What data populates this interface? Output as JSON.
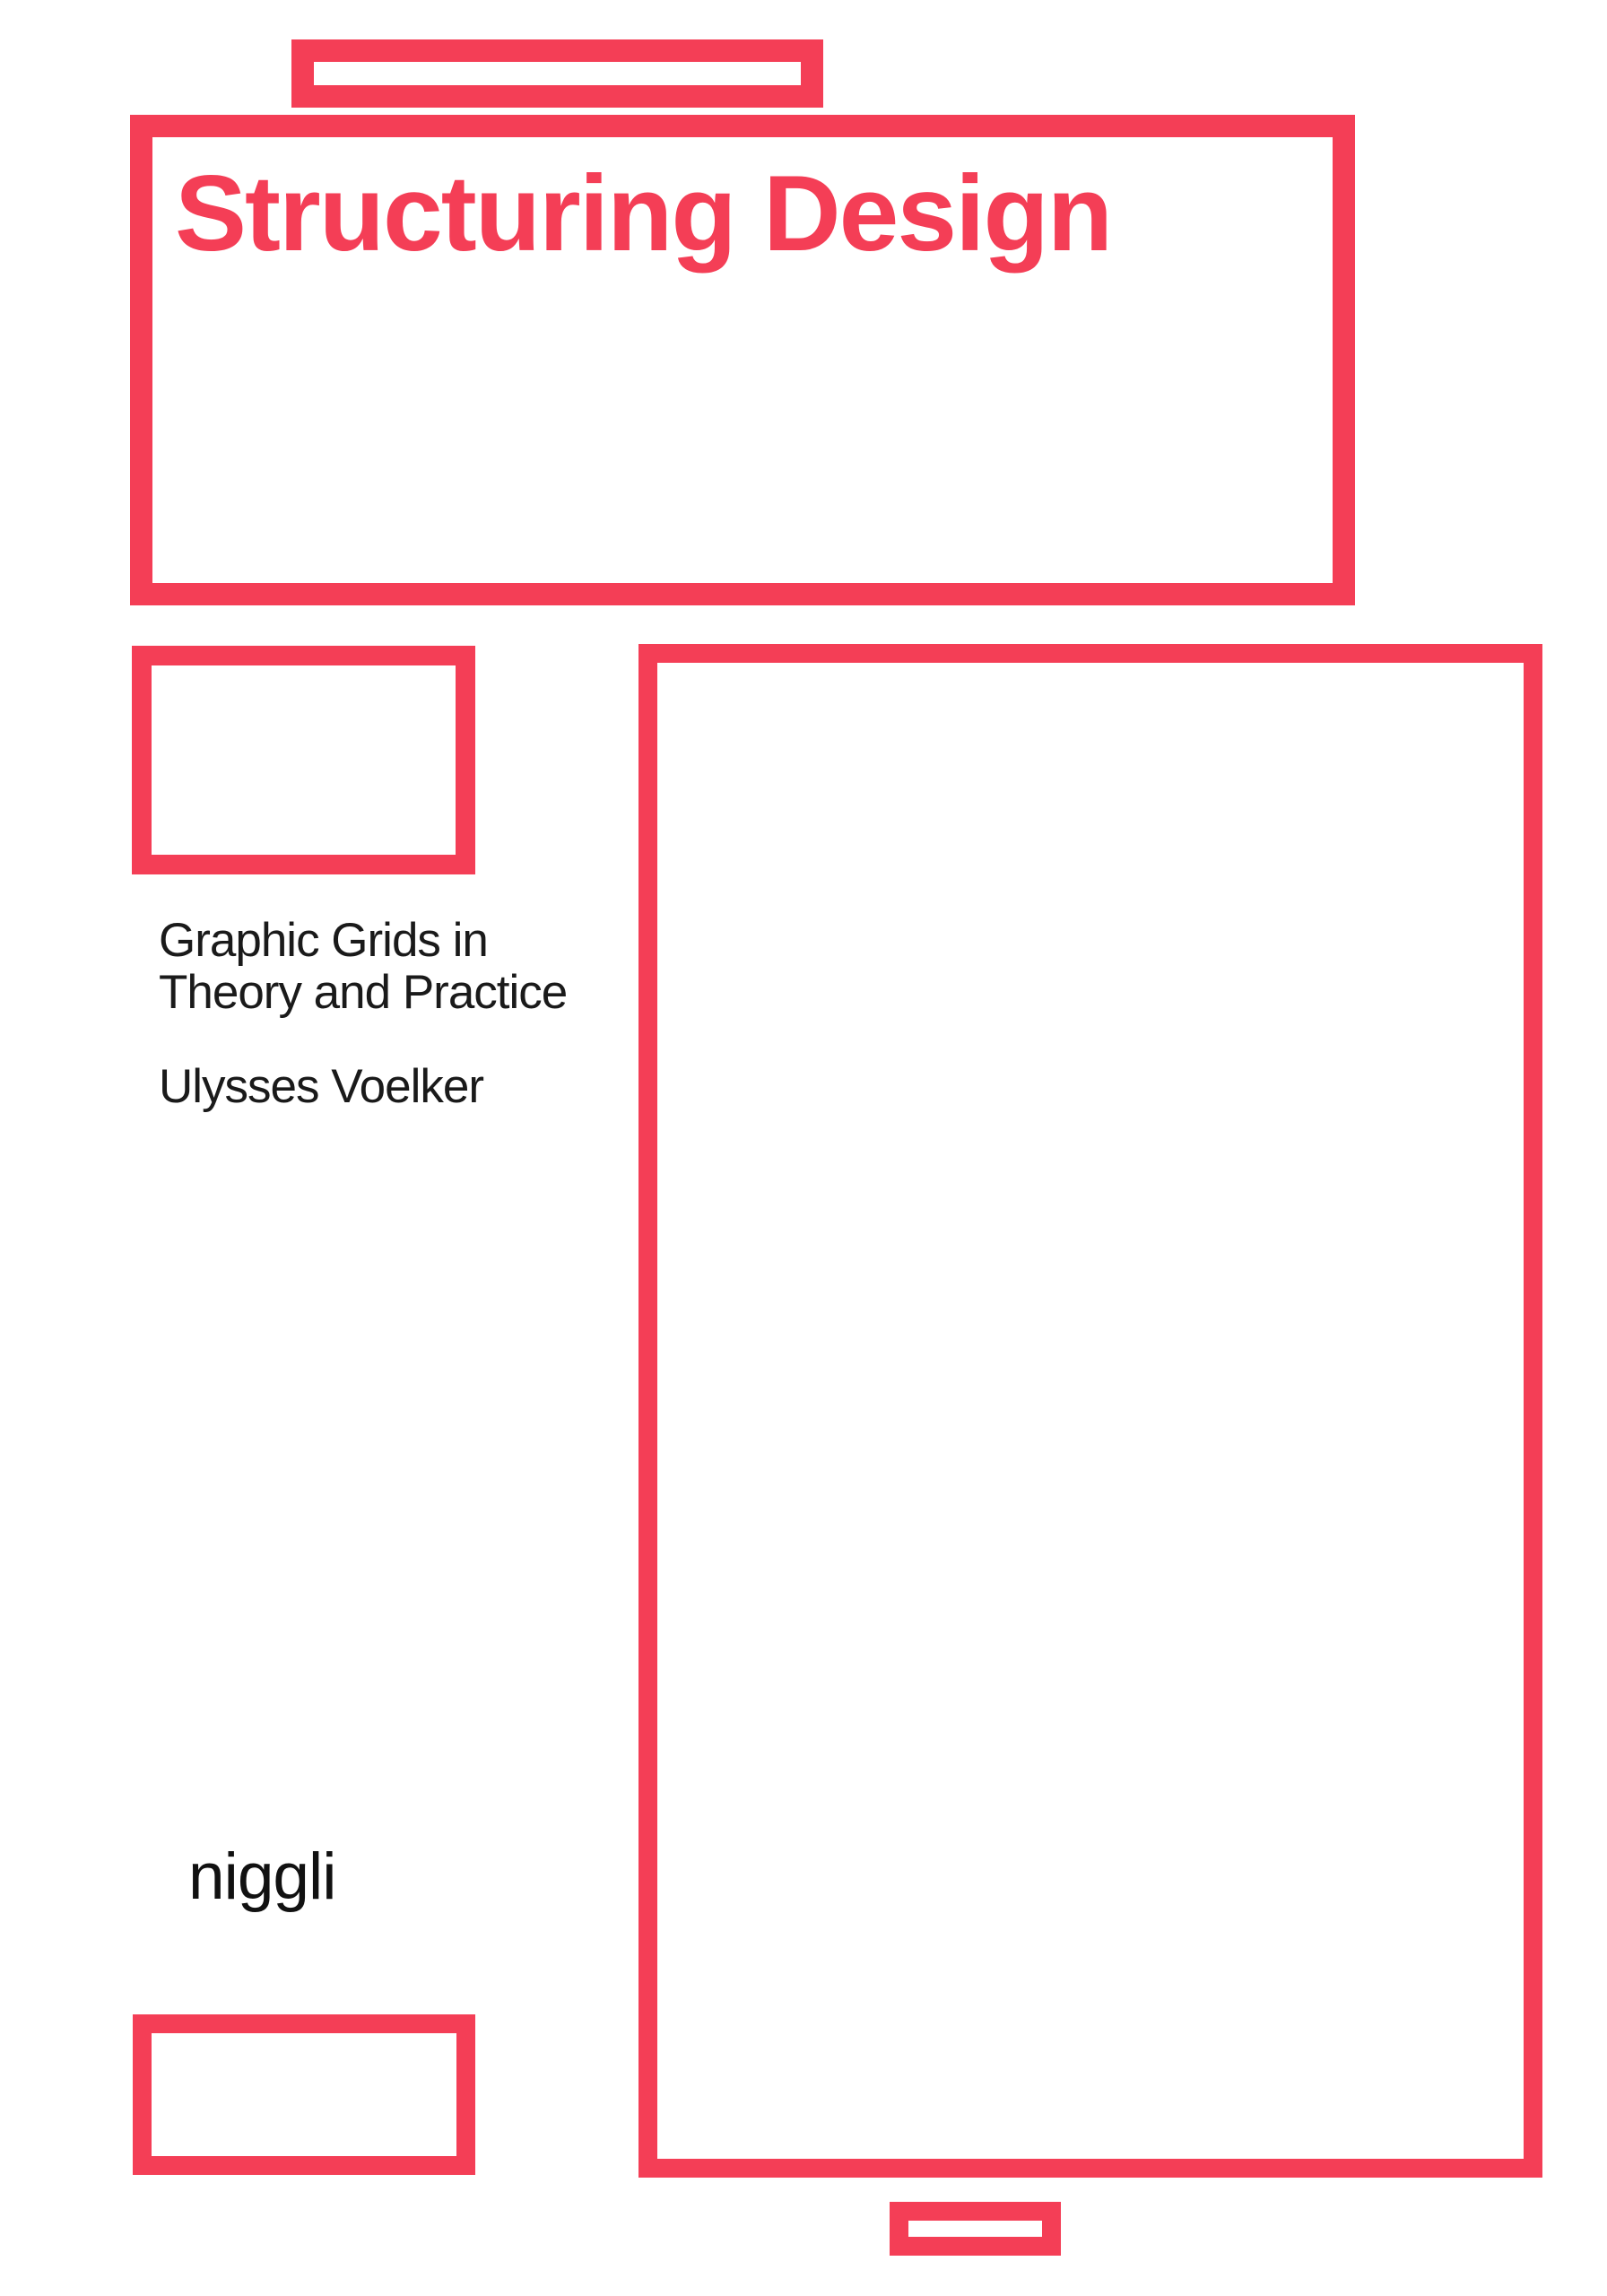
{
  "colors": {
    "accent": "#f43e56",
    "text": "#1a1a1a",
    "background": "#ffffff"
  },
  "cover": {
    "title": "Structuring Design",
    "subtitle_lines": [
      "Graphic Grids in",
      "Theory and Practice"
    ],
    "author": "Ulysses Voelker",
    "publisher": "niggli"
  }
}
